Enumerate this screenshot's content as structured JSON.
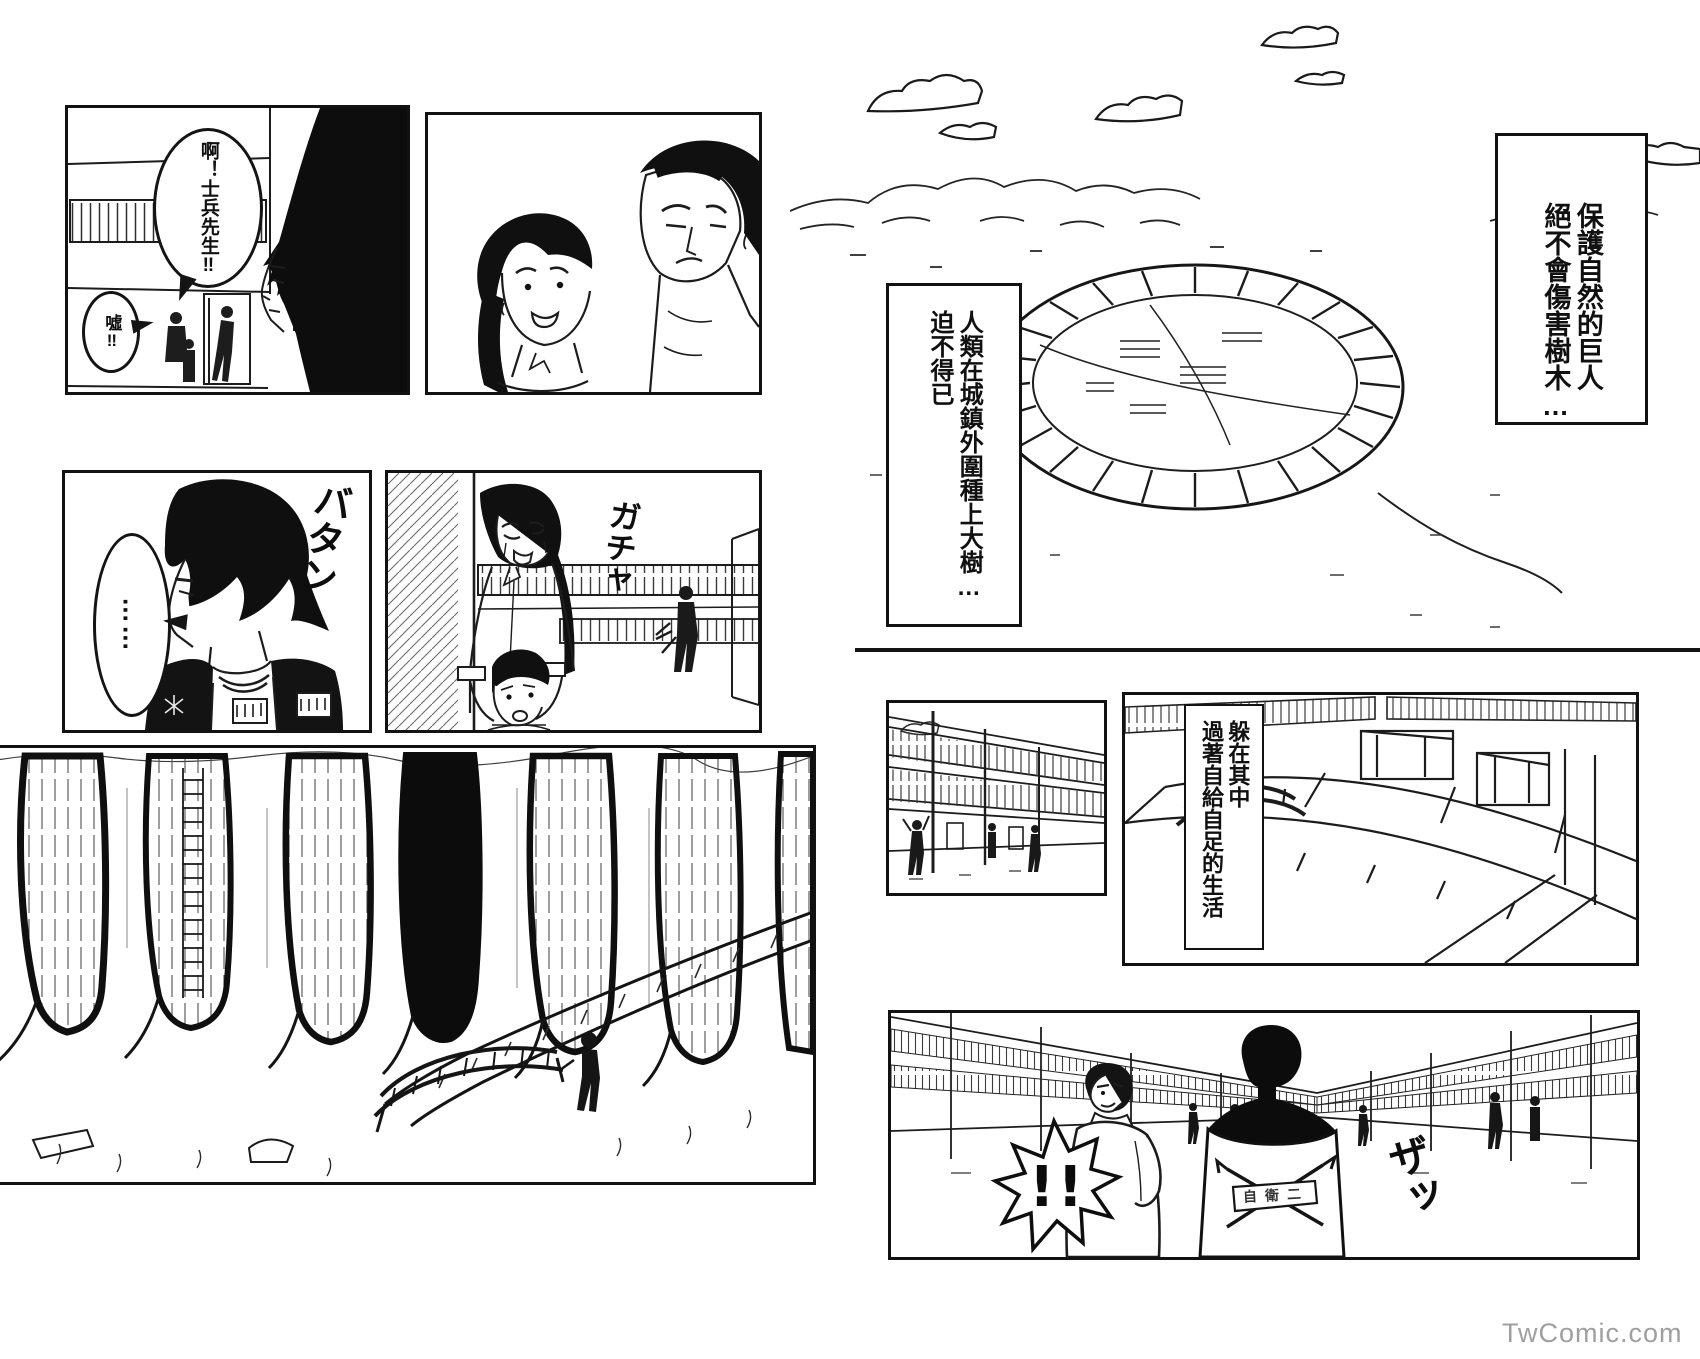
{
  "left_page": {
    "panel_street_call": {
      "bubble_shout": "啊！士兵先生‼",
      "bubble_hush": "噓‼"
    },
    "panel_silence": {
      "bubble_dots": "……",
      "sfx_batan": "バタン"
    },
    "panel_doorway": {
      "sfx_gacha": "ガチャ"
    }
  },
  "right_page": {
    "narration_giant": "保護自然的巨人\n絕不會傷害樹木…",
    "narration_trees": "人類在城鎮外圍種上大樹…\n迫不得已",
    "narration_hide": "躲在其中\n過著自給自足的生活",
    "panel_street": {
      "burst_exclaim": "!!",
      "sfx_za": "ザッ",
      "jacket_emblem": "自衛二"
    }
  },
  "watermark": "TwComic.com"
}
